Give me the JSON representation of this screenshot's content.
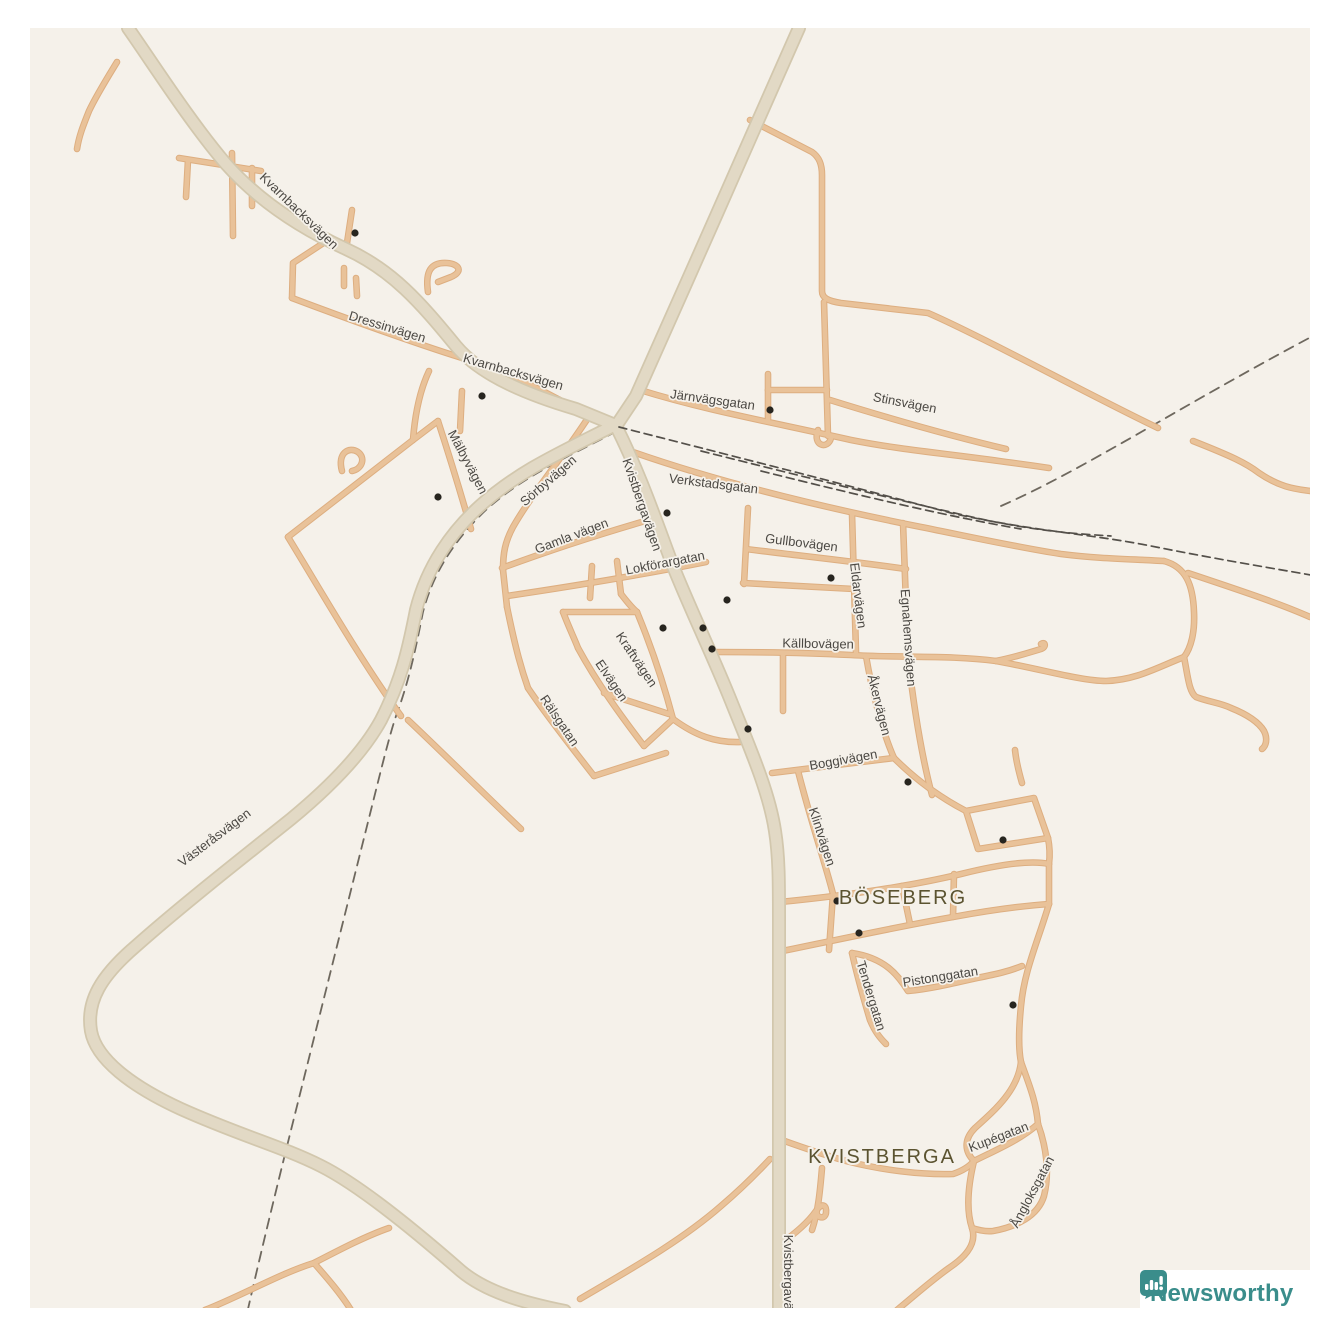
{
  "map": {
    "colors": {
      "outer_background": "#ffffff",
      "map_background": "#f5f1ea",
      "major_road_fill": "#e2d9c5",
      "major_road_casing": "#d2c7ad",
      "minor_road_fill": "#e9c299",
      "minor_road_casing": "#ddae80",
      "railway": "#54504a",
      "boundary": "#6e685e",
      "poi_dot": "#27251f",
      "street_label": "#4b4843",
      "place_label": "#5b5330"
    },
    "place_labels": [
      {
        "text": "BÖSEBERG",
        "x": 903,
        "y": 904,
        "rotation": 0
      },
      {
        "text": "KVISTBERGA",
        "x": 882,
        "y": 1163,
        "rotation": 0
      }
    ],
    "street_labels": [
      {
        "text": "Kvarnbacksvägen",
        "x": 296,
        "y": 214,
        "rotation": 44
      },
      {
        "text": "Dressinvägen",
        "x": 386,
        "y": 331,
        "rotation": 17
      },
      {
        "text": "Kvarnbacksvägen",
        "x": 512,
        "y": 376,
        "rotation": 16
      },
      {
        "text": "Järnvägsgatan",
        "x": 712,
        "y": 404,
        "rotation": 8
      },
      {
        "text": "Stinsvägen",
        "x": 904,
        "y": 407,
        "rotation": 11
      },
      {
        "text": "Mälbyvägen",
        "x": 464,
        "y": 464,
        "rotation": 62
      },
      {
        "text": "Sörbyvägen",
        "x": 551,
        "y": 484,
        "rotation": -41
      },
      {
        "text": "Verkstadsgatan",
        "x": 713,
        "y": 488,
        "rotation": 7
      },
      {
        "text": "Kvistbergavägen",
        "x": 638,
        "y": 506,
        "rotation": 71
      },
      {
        "text": "Gamla vägen",
        "x": 573,
        "y": 540,
        "rotation": -21
      },
      {
        "text": "Gullbovägen",
        "x": 801,
        "y": 547,
        "rotation": 7
      },
      {
        "text": "Lokförargatan",
        "x": 666,
        "y": 567,
        "rotation": -11
      },
      {
        "text": "Eldarvägen",
        "x": 854,
        "y": 596,
        "rotation": 83
      },
      {
        "text": "Egnahemsvägen",
        "x": 904,
        "y": 638,
        "rotation": 86
      },
      {
        "text": "Källbovägen",
        "x": 818,
        "y": 648,
        "rotation": 1
      },
      {
        "text": "Åkervägen",
        "x": 875,
        "y": 706,
        "rotation": 76
      },
      {
        "text": "Kraftvägen",
        "x": 633,
        "y": 662,
        "rotation": 56
      },
      {
        "text": "Elvägen",
        "x": 608,
        "y": 683,
        "rotation": 56
      },
      {
        "text": "Rälsgatan",
        "x": 556,
        "y": 723,
        "rotation": 56
      },
      {
        "text": "Boggivägen",
        "x": 844,
        "y": 764,
        "rotation": -10
      },
      {
        "text": "Klintvägen",
        "x": 818,
        "y": 838,
        "rotation": 72
      },
      {
        "text": "Västeråsvägen",
        "x": 217,
        "y": 841,
        "rotation": -37
      },
      {
        "text": "Tendergatan",
        "x": 867,
        "y": 997,
        "rotation": 73
      },
      {
        "text": "Pistonggatan",
        "x": 941,
        "y": 981,
        "rotation": -9
      },
      {
        "text": "Kupégatan",
        "x": 1000,
        "y": 1141,
        "rotation": -21
      },
      {
        "text": "Ångloksgatan",
        "x": 1036,
        "y": 1194,
        "rotation": -62
      },
      {
        "text": "Kvistbergavägen",
        "x": 784,
        "y": 1283,
        "rotation": 90
      }
    ],
    "poi_dots": [
      [
        355,
        233
      ],
      [
        482,
        396
      ],
      [
        770,
        410
      ],
      [
        438,
        497
      ],
      [
        667,
        513
      ],
      [
        831,
        578
      ],
      [
        727,
        600
      ],
      [
        663,
        628
      ],
      [
        703,
        628
      ],
      [
        712,
        649
      ],
      [
        748,
        729
      ],
      [
        908,
        782
      ],
      [
        1003,
        840
      ],
      [
        837,
        901
      ],
      [
        859,
        933
      ],
      [
        1013,
        1005
      ]
    ]
  },
  "branding": {
    "logo_text": "Newsworthy"
  }
}
